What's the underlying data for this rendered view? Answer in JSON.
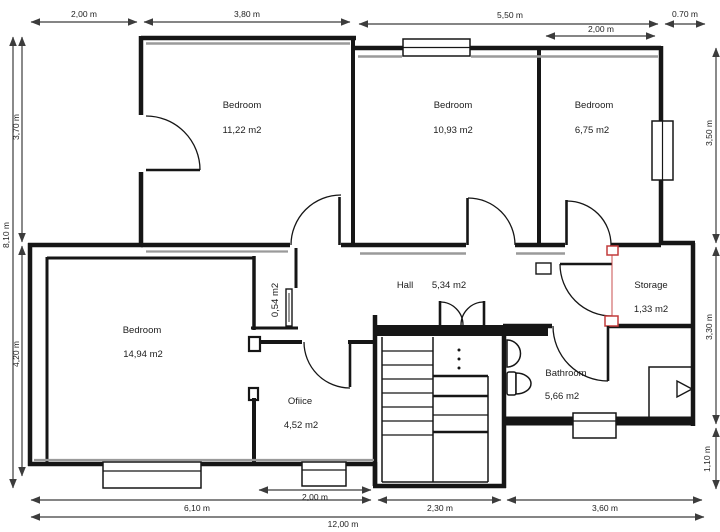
{
  "plan": {
    "title": "Floor plan",
    "rooms": {
      "bedroom_top_left": {
        "name": "Bedroom",
        "area": "11,22 m2"
      },
      "bedroom_top_mid": {
        "name": "Bedroom",
        "area": "10,93 m2"
      },
      "bedroom_top_right": {
        "name": "Bedroom",
        "area": "6,75 m2"
      },
      "hall": {
        "name": "Hall",
        "area": "5,34 m2"
      },
      "storage": {
        "name": "Storage",
        "area": "1,33 m2"
      },
      "bedroom_left": {
        "name": "Bedroom",
        "area": "14,94 m2"
      },
      "office": {
        "name": "Ofiice",
        "area": "4,52 m2"
      },
      "bathroom": {
        "name": "Bathroom",
        "area": "5,66 m2"
      },
      "closet": {
        "area": "0,54 m2"
      }
    },
    "dimensions": {
      "top": [
        "2,00 m",
        "3,80 m",
        "5,50 m",
        "0.70 m",
        "2,00 m"
      ],
      "left": [
        "3,70 m",
        "8,10 m",
        "4,20 m"
      ],
      "right": [
        "3,50 m",
        "3,30 m",
        "1,10 m"
      ],
      "bottom": [
        "2,00 m",
        "6,10 m",
        "2,30 m",
        "3,60 m",
        "12,00 m"
      ]
    },
    "colors": {
      "wall": "#161616",
      "dimension_line": "#3c3c3c",
      "door_marker_red": "#c23b3b",
      "inner_line_gray": "#9a9a9a",
      "background": "#ffffff"
    }
  }
}
